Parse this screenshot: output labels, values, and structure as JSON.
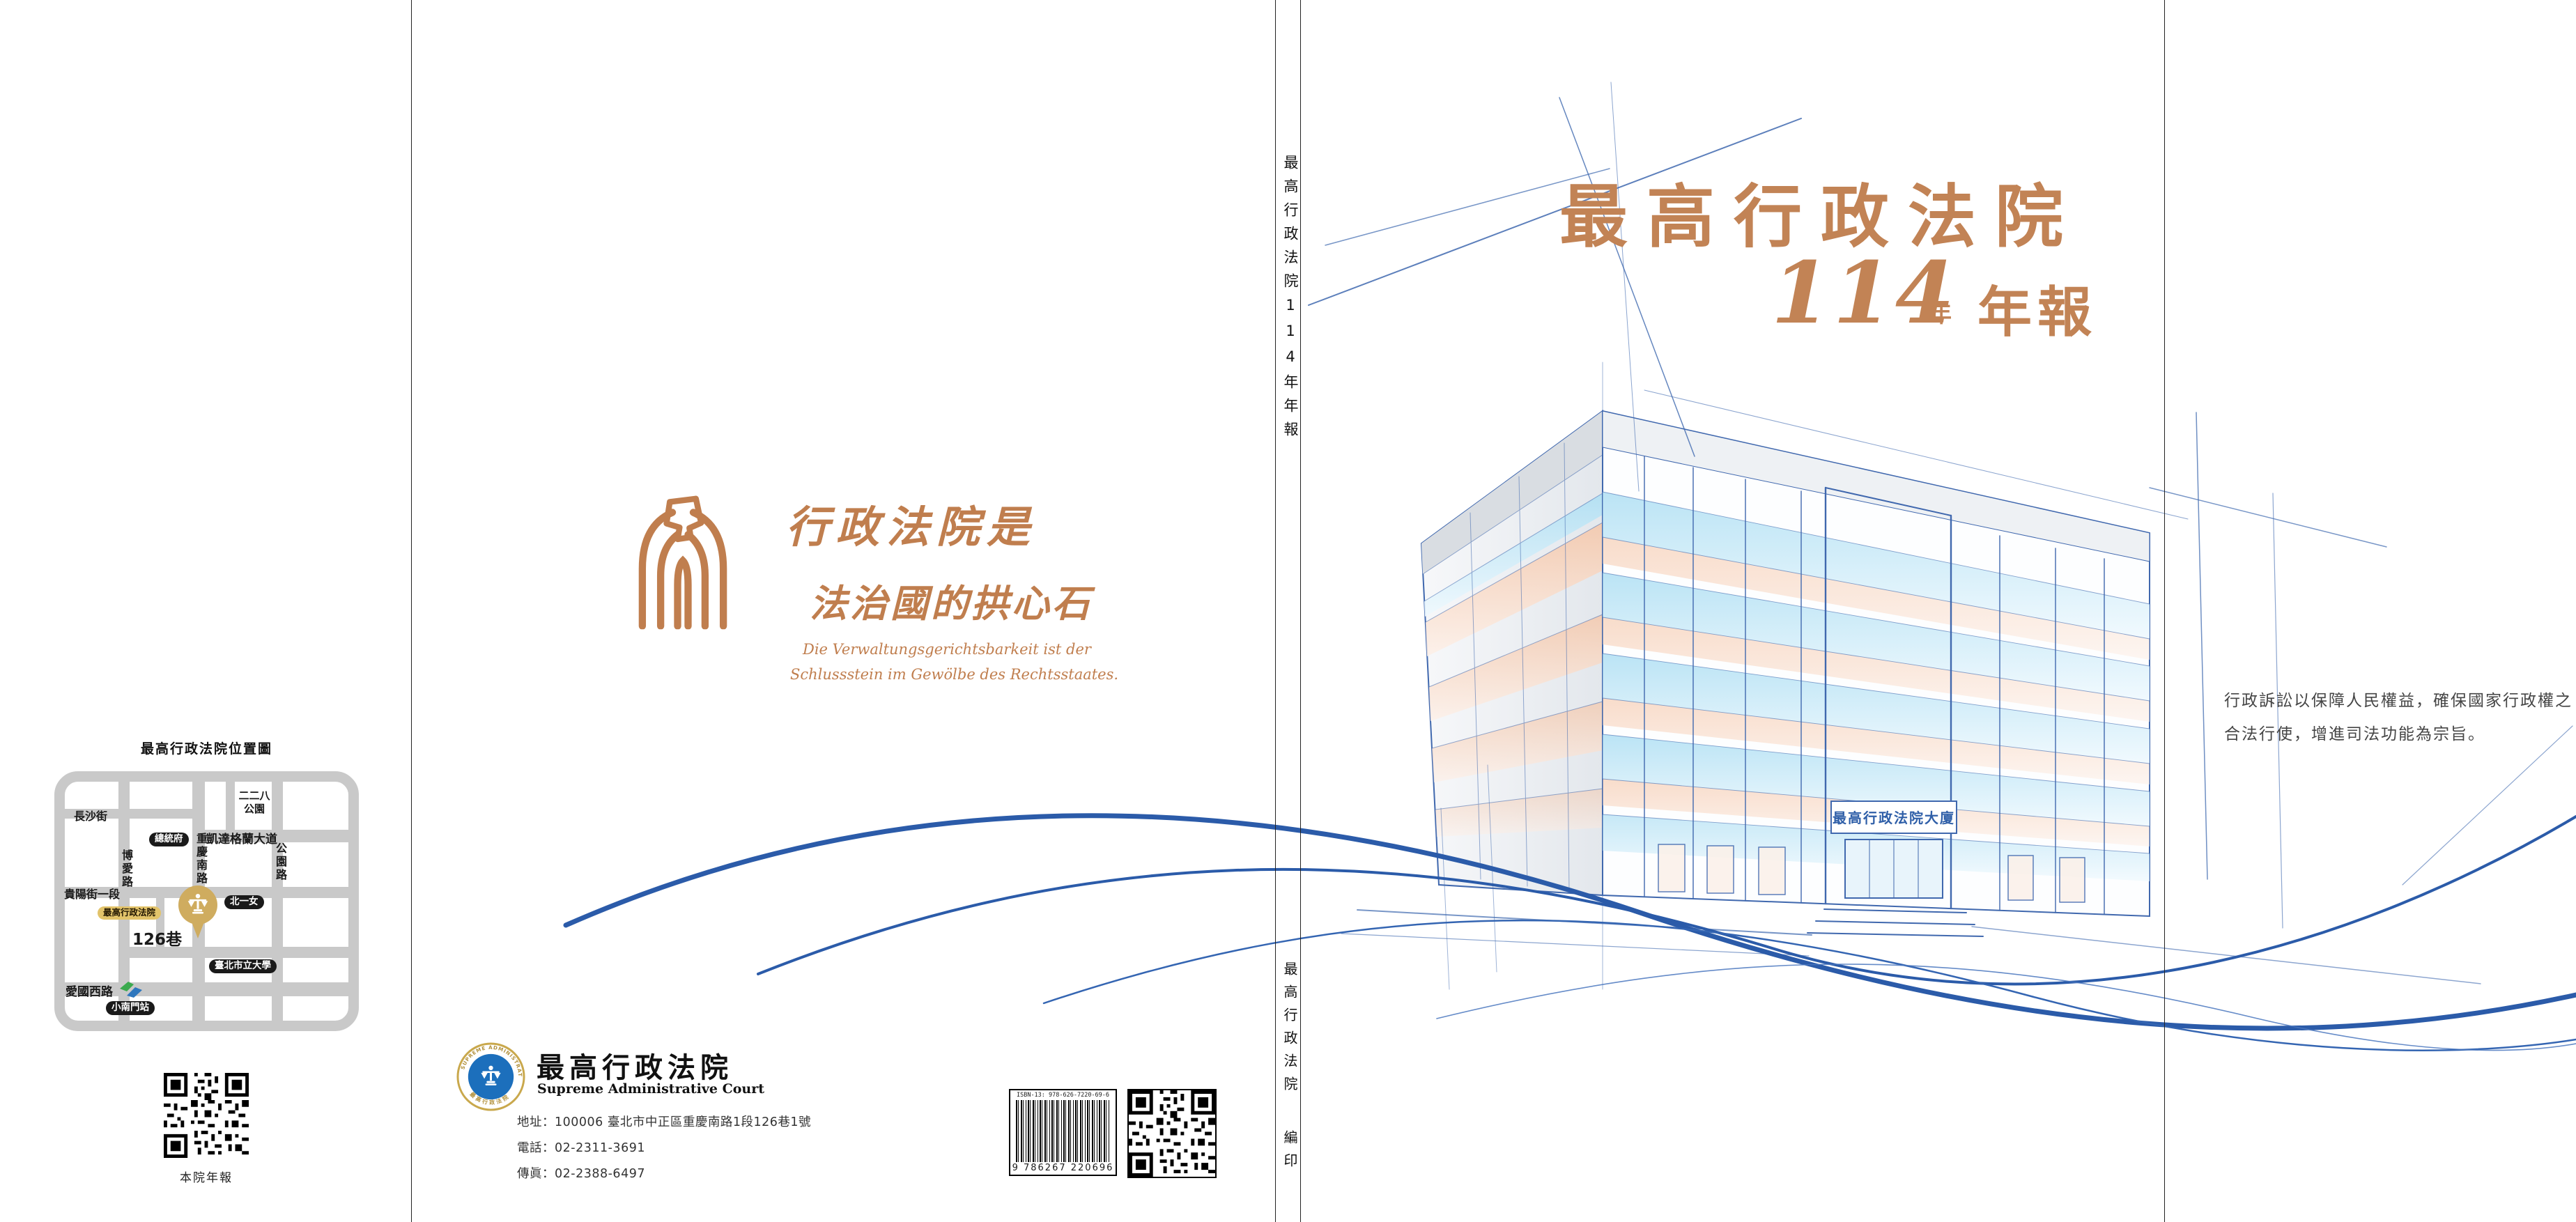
{
  "palette": {
    "terracotta": "#C28355",
    "swoosh_blue": "#2B5BA9",
    "sketch_blue": "#3F69AF",
    "map_road_gray": "#C9C9C9",
    "gold": "#CFAC5F",
    "gold_pill": "#E2C36A",
    "seal_blue": "#1C6FBC",
    "peach": "#F5C6A8",
    "window_blue": "#AFDFF3"
  },
  "left_flap": {
    "map": {
      "title": "最高行政法院位置圖",
      "streets": {
        "changsha": "長沙街",
        "ketagalan": "凱達格蘭大道",
        "boai": "博愛路",
        "chongqing_south": "重慶南路",
        "gongyuan": "公園路",
        "guiyang_sec1": "貴陽街一段",
        "aiguo_west": "愛國西路",
        "lane126": "126巷"
      },
      "landmarks": {
        "park_228_line1": "二二八",
        "park_228_line2": "公園",
        "presidential_office": "總統府",
        "supreme_admin_court": "最高行政法院",
        "first_girls_high": "北一女",
        "university_taipei": "臺北市立大學",
        "xiaonanmen_station": "小南門站"
      }
    },
    "qr_caption": "本院年報"
  },
  "back_cover": {
    "motto_zh_line1": "行政法院是",
    "motto_zh_line2": "法治國的拱心石",
    "motto_de_line1": "Die Verwaltungsgerichtsbarkeit ist der",
    "motto_de_line2": "Schlussstein im Gewölbe des Rechtsstaates.",
    "org_zh": "最高行政法院",
    "org_en": "Supreme Administrative Court",
    "seal_ring_top": "SUPREME ADMINISTRATIVE COURT",
    "seal_ring_bottom": "最高行政法院",
    "address": "地址：100006 臺北市中正區重慶南路1段126巷1號",
    "phone": "電話：02-2311-3691",
    "fax": "傳眞：02-2388-6497",
    "isbn_label": "ISBN-13: 978-626-7220-69-6",
    "barcode_digits": "9 786267 220696"
  },
  "spine": {
    "title": "最高行政法院114年年報",
    "publisher": "最高行政法院",
    "imprint": "編印"
  },
  "front_cover": {
    "title": "最高行政法院",
    "year": "114",
    "year_unit": "年",
    "report": "年報",
    "building_plaque": "最高行政法院大廈"
  },
  "right_flap": {
    "mission_line1": "行政訴訟以保障人民權益，確保國家行政權之",
    "mission_line2": "合法行使，增進司法功能為宗旨。"
  }
}
